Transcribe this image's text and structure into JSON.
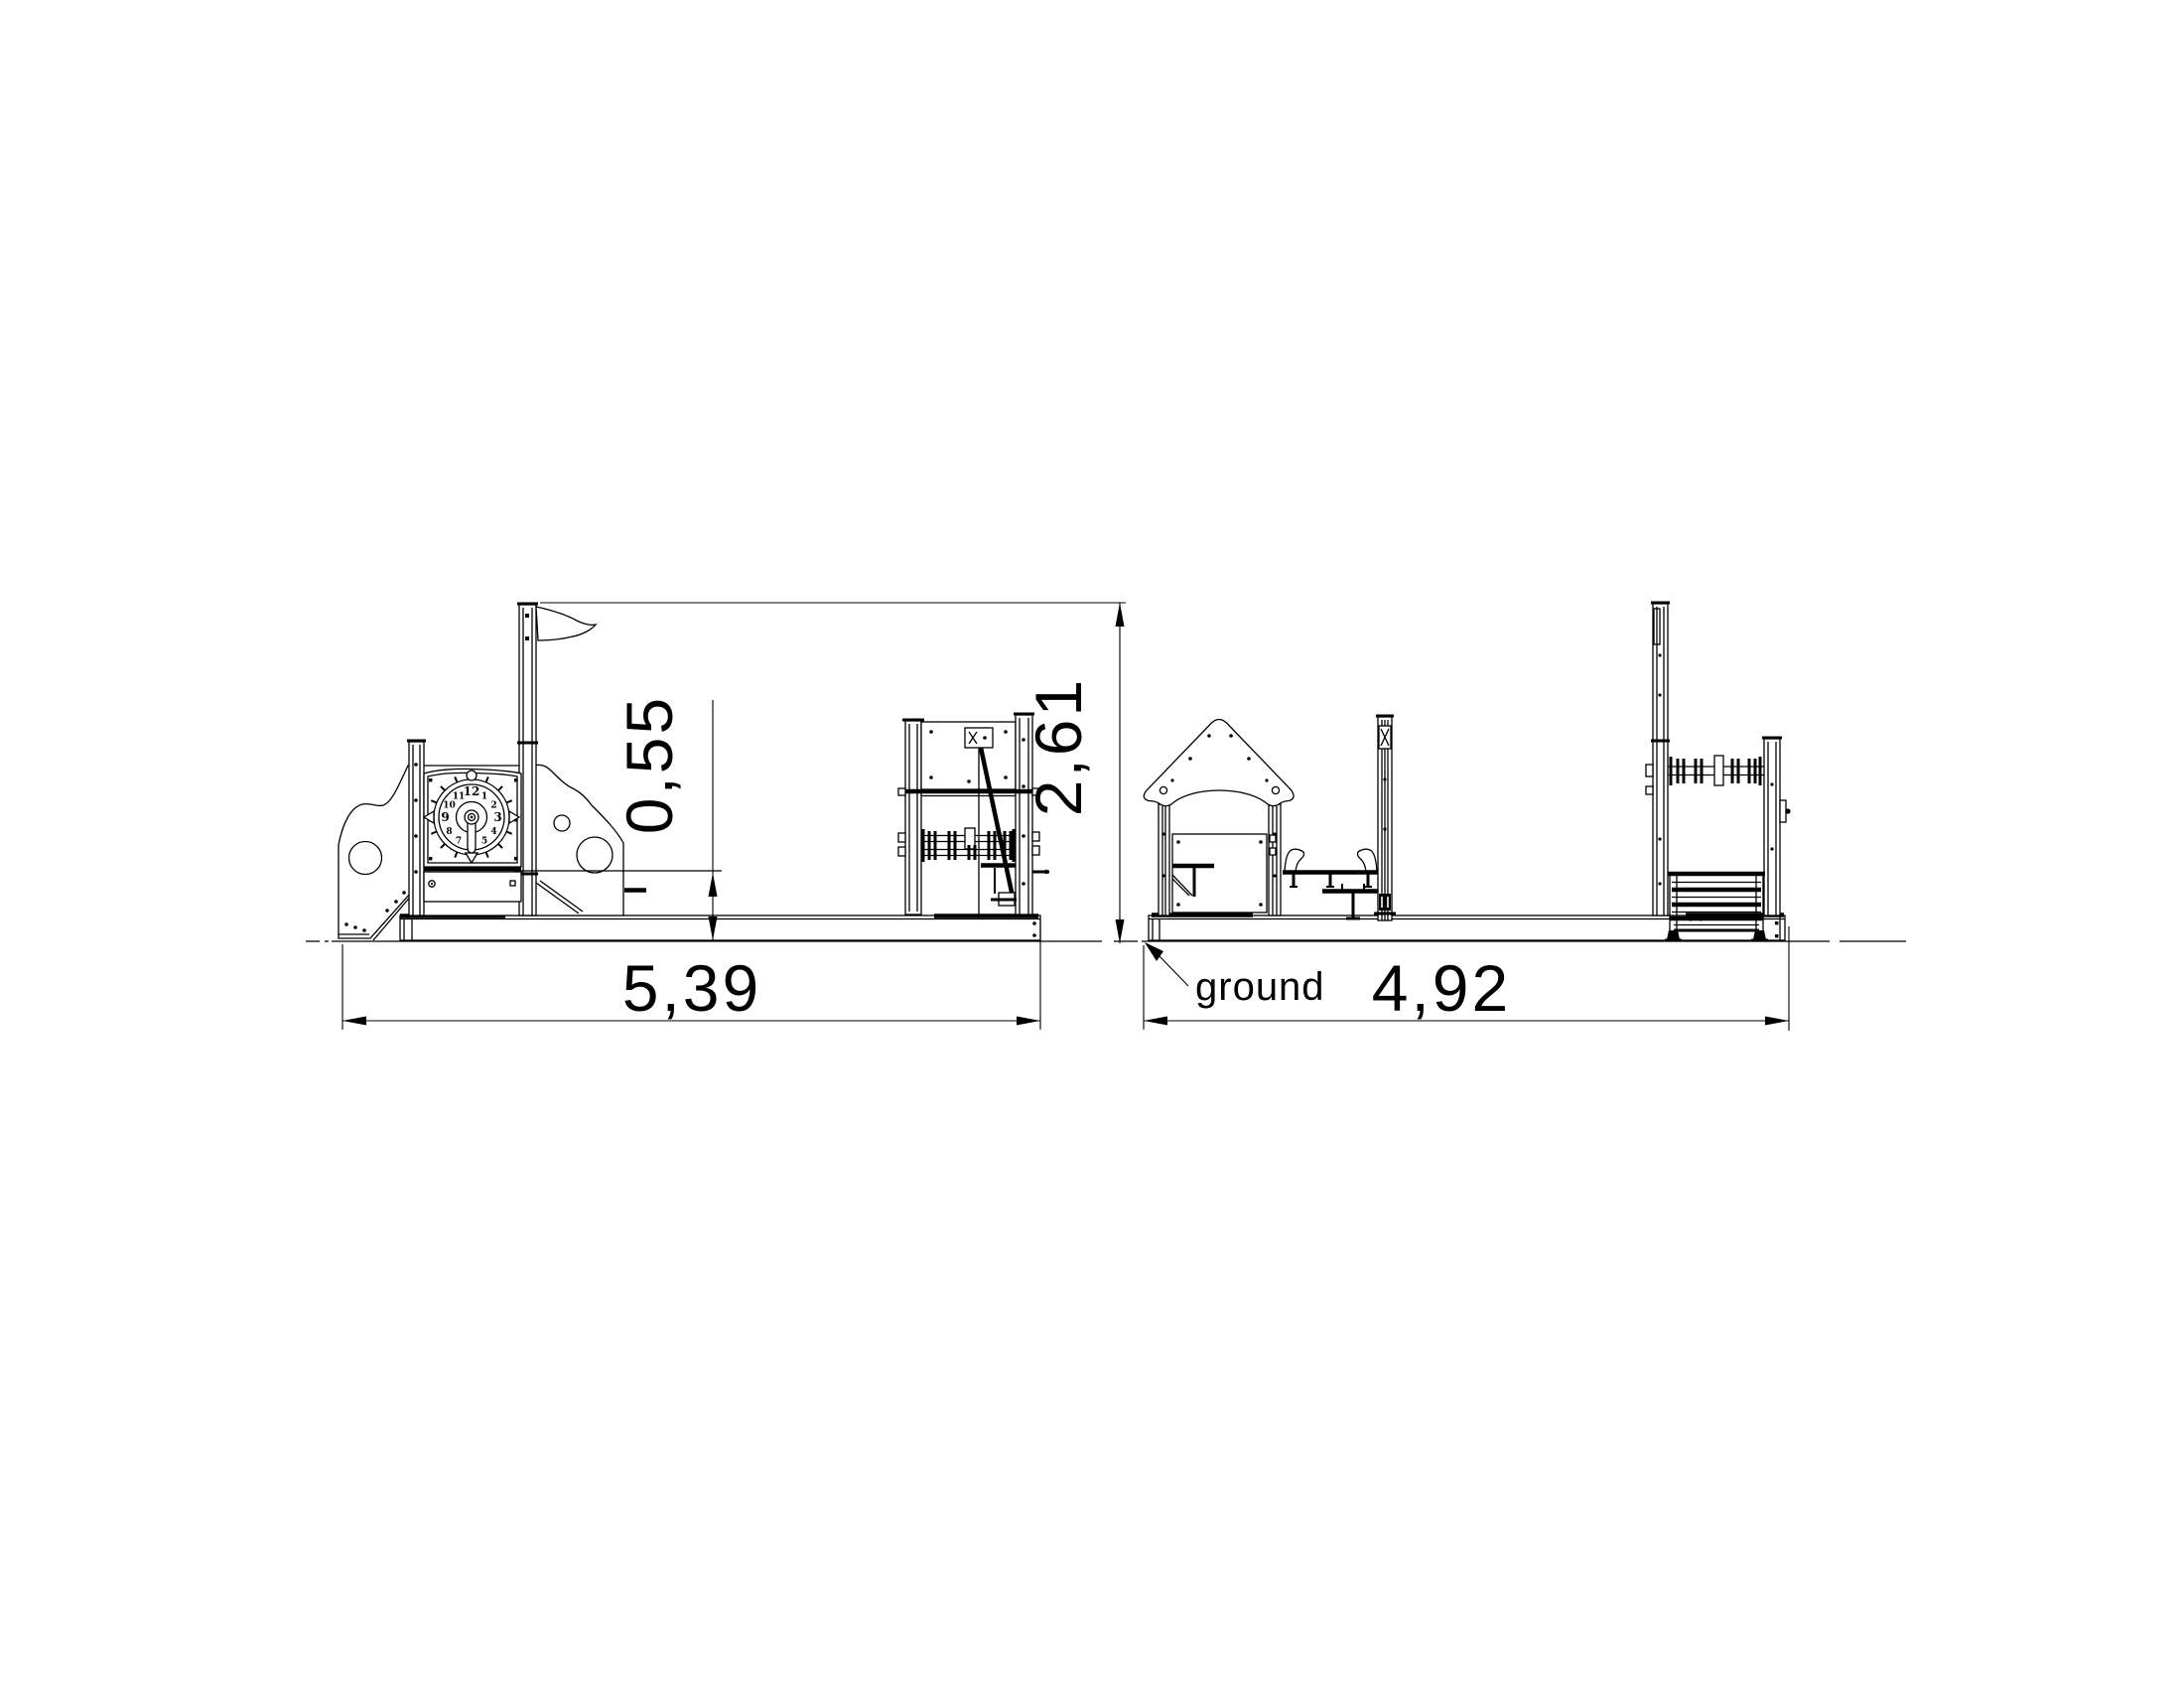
{
  "page": {
    "background": "#ffffff",
    "line_color": "#000000",
    "text_color": "#000000"
  },
  "dimensions": {
    "side_overall_length": "5,39",
    "deck_height": "0,55",
    "overall_height": "2,61",
    "front_overall_length": "4,92"
  },
  "labels": {
    "ground": "ground"
  },
  "clock": {
    "numbers": [
      "12",
      "1",
      "2",
      "3",
      "4",
      "5",
      "6",
      "7",
      "8",
      "9",
      "10",
      "11"
    ]
  }
}
